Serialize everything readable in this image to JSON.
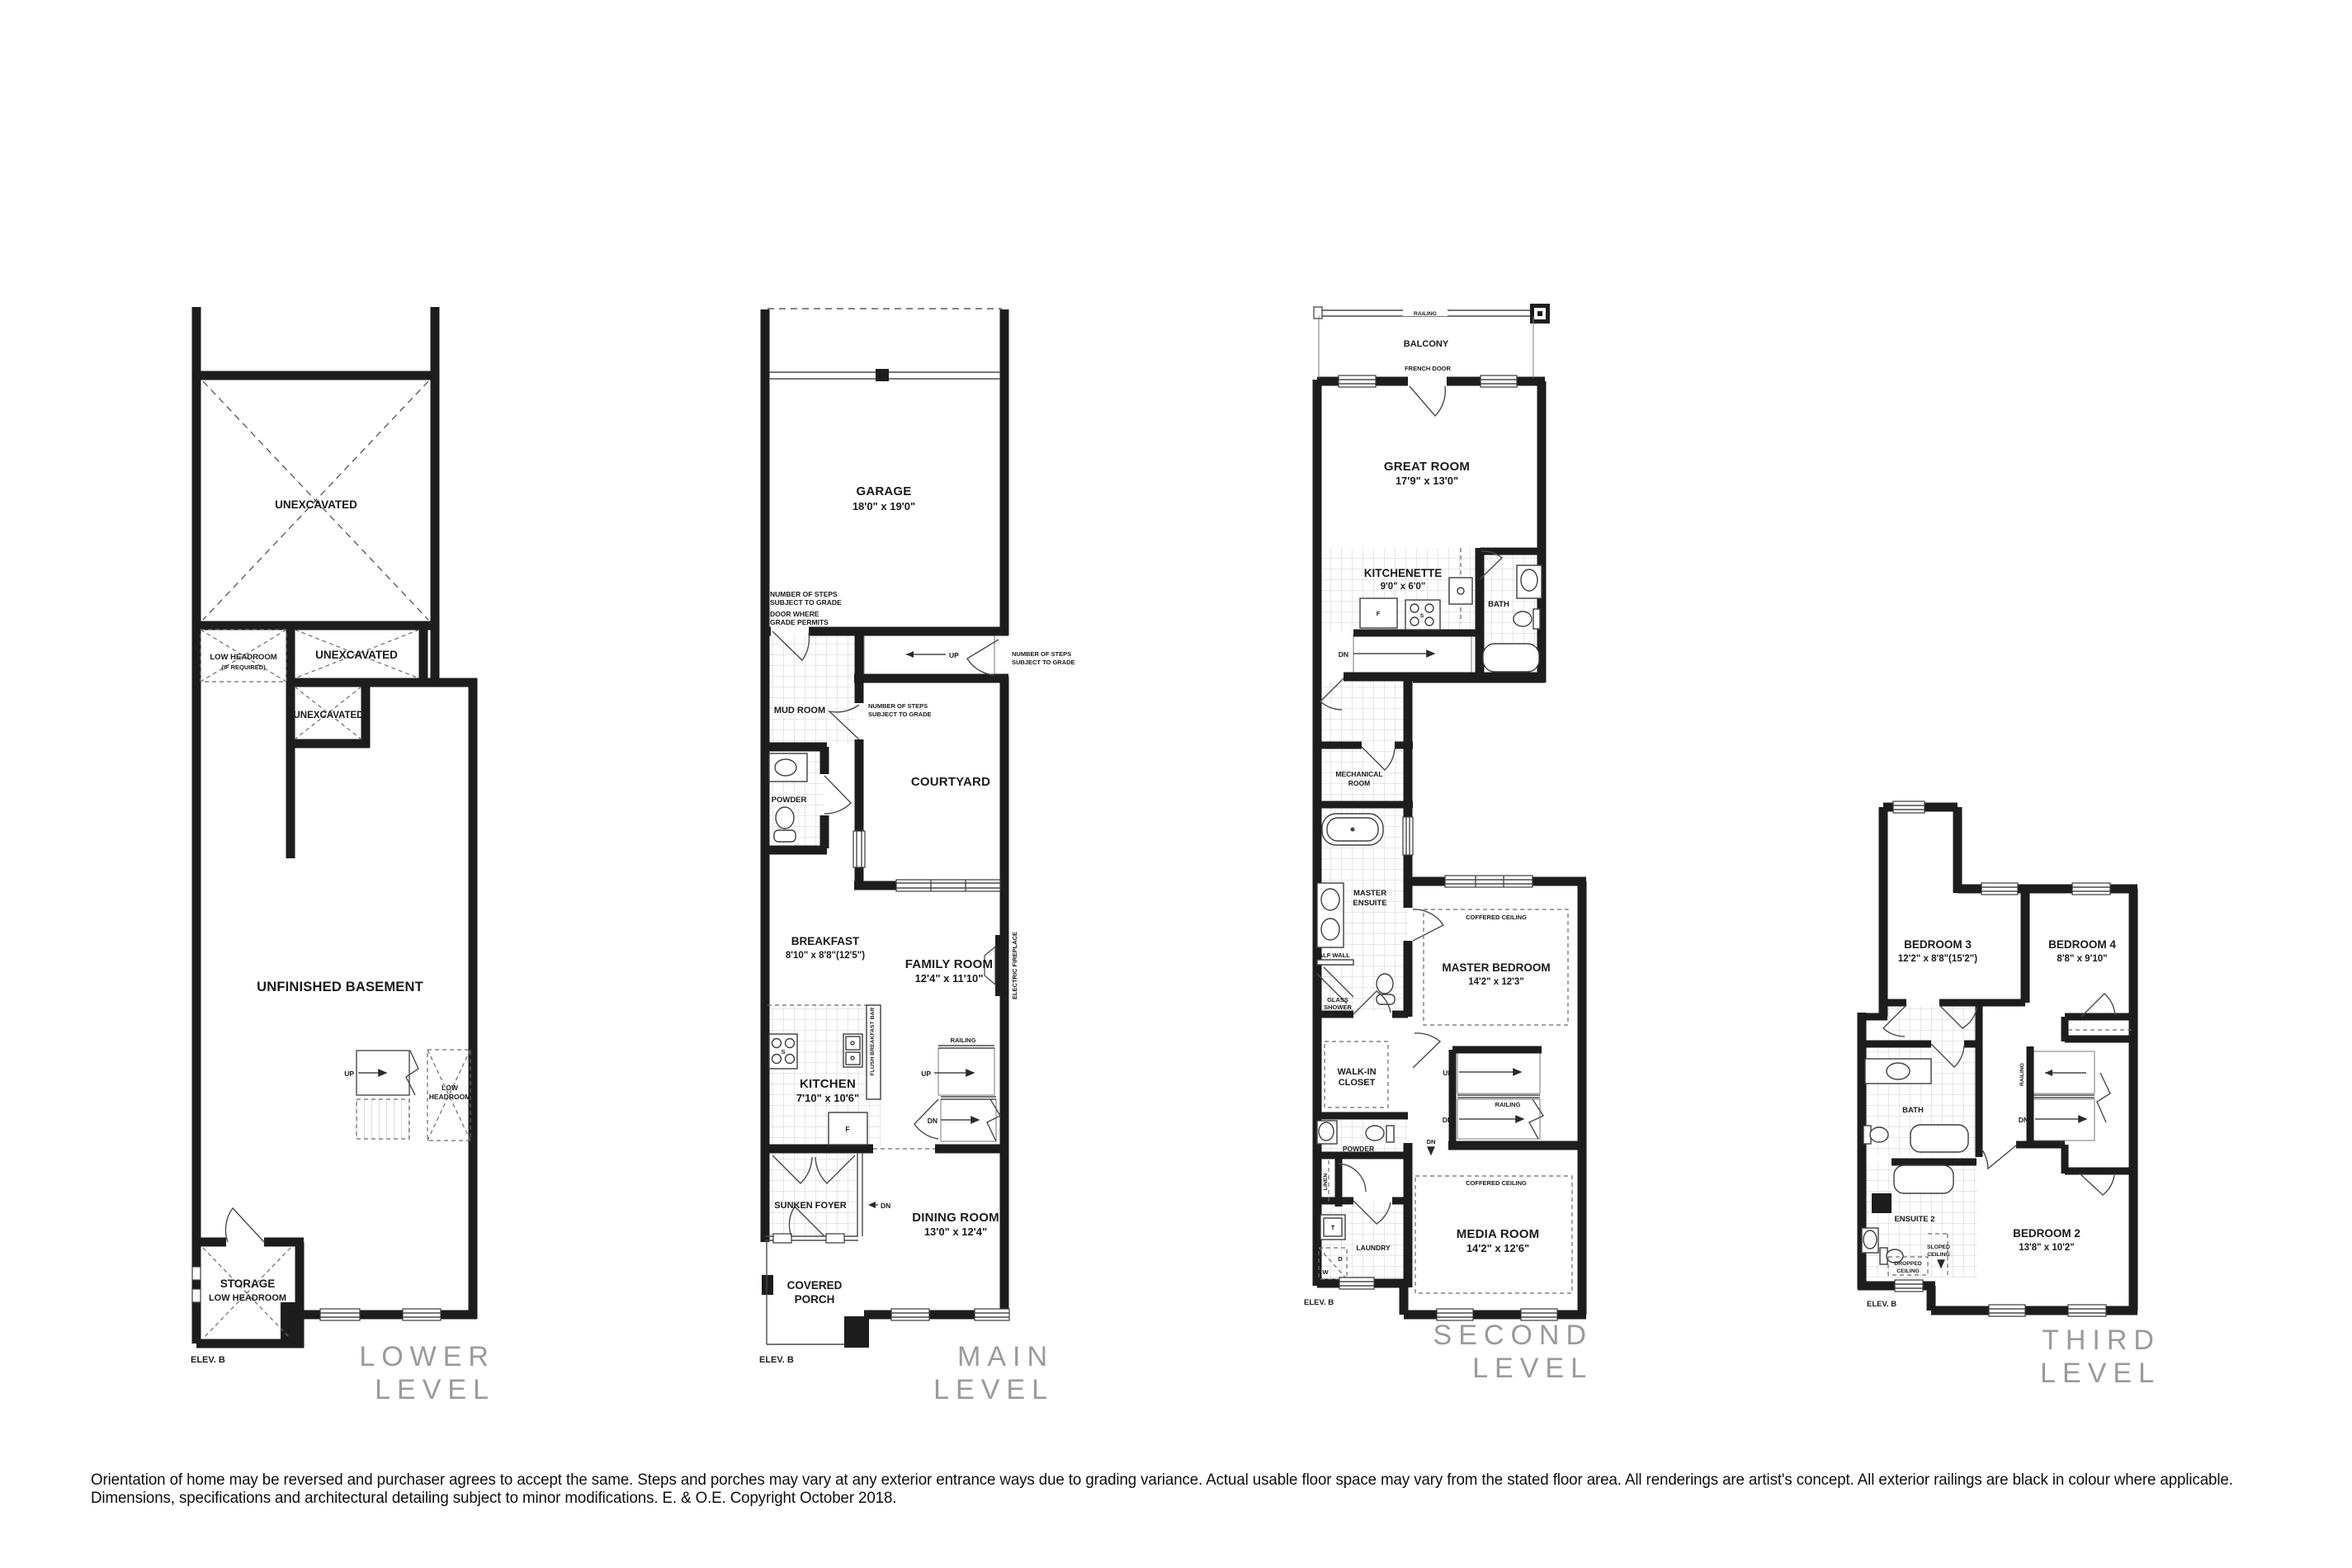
{
  "colors": {
    "wall": "#1d1d1d",
    "muted_title": "#9a9a9e",
    "tile_line": "#cfcfcf"
  },
  "disclaimer": "Orientation of home may be reversed and purchaser agrees to accept the same. Steps and porches may vary at any exterior entrance ways due to grading variance. Actual usable floor space may vary from the stated floor area. All renderings are artist's concept. All exterior railings are black in colour where applicable. Dimensions, specifications and architectural detailing subject to minor modifications. E. & O.E. Copyright October 2018.",
  "levels": {
    "lower": {
      "title": [
        "LOWER",
        "LEVEL"
      ],
      "elev": "ELEV. B",
      "labels": {
        "unex_big": "UNEXCAVATED",
        "lh1": "LOW HEADROOM",
        "lh2": "(IF REQUIRED)",
        "unex_wide": "UNEXCAVATED",
        "unex_small": "UNEXCAVATED",
        "basement": "UNFINISHED BASEMENT",
        "up": "UP",
        "low1": "LOW",
        "low2": "HEADROOM",
        "storage1": "STORAGE",
        "storage2": "LOW HEADROOM"
      }
    },
    "main": {
      "title": [
        "MAIN",
        "LEVEL"
      ],
      "elev": "ELEV. B",
      "labels": {
        "garage": "GARAGE",
        "garage_dim": "18'0\" x 19'0\"",
        "steps1a": "NUMBER OF STEPS",
        "steps1b": "SUBJECT TO GRADE",
        "door1a": "DOOR WHERE",
        "door1b": "GRADE PERMITS",
        "mud": "MUD ROOM",
        "up1": "UP",
        "steps2a": "NUMBER OF STEPS",
        "steps2b": "SUBJECT TO GRADE",
        "steps3a": "NUMBER OF STEPS",
        "steps3b": "SUBJECT TO GRADE",
        "powder": "POWDER",
        "courtyard": "COURTYARD",
        "breakfast": "BREAKFAST",
        "breakfast_dim": "8'10\" x 8'8\"(12'5\")",
        "family": "FAMILY ROOM",
        "family_dim": "12'4\" x 11'10\"",
        "fireplace": "ELECTRIC FIREPLACE",
        "kitchen": "KITCHEN",
        "kitchen_dim": "7'10\" x 10'6\"",
        "flush": "FLUSH BREAKFAST BAR",
        "railing": "RAILING",
        "up2": "UP",
        "dn1": "DN",
        "f": "F",
        "s": "S",
        "foyer": "SUNKEN FOYER",
        "dn2": "DN",
        "dining": "DINING ROOM",
        "dining_dim": "13'0\" x 12'4\"",
        "porch1": "COVERED",
        "porch2": "PORCH"
      }
    },
    "second": {
      "title": [
        "SECOND",
        "LEVEL"
      ],
      "elev": "ELEV. B",
      "labels": {
        "railing1": "RAILING",
        "balcony": "BALCONY",
        "french": "FRENCH DOOR",
        "great": "GREAT ROOM",
        "great_dim": "17'9\" x 13'0\"",
        "kitchenette": "KITCHENETTE",
        "kitchenette_dim": "9'0\" x 6'0\"",
        "f": "F",
        "s": "S",
        "bath": "BATH",
        "dn1": "DN",
        "mech1": "MECHANICAL",
        "mech2": "ROOM",
        "ens1": "MASTER",
        "ens2": "ENSUITE",
        "halfwall": "HALF WALL",
        "glass1": "GLASS",
        "glass2": "SHOWER",
        "coffered1": "COFFERED CEILING",
        "master": "MASTER BEDROOM",
        "master_dim": "14'2\" x 12'3\"",
        "walkin1": "WALK-IN",
        "walkin2": "CLOSET",
        "up": "UP",
        "railing2": "RAILING",
        "dn2": "DN",
        "powder": "POWDER",
        "dn3": "DN",
        "linen": "LINEN",
        "coffered2": "COFFERED CEILING",
        "t": "T",
        "d": "D",
        "w": "W",
        "laundry": "LAUNDRY",
        "media": "MEDIA ROOM",
        "media_dim": "14'2\" x 12'6\""
      }
    },
    "third": {
      "title": [
        "THIRD",
        "LEVEL"
      ],
      "elev": "ELEV. B",
      "labels": {
        "bed3": "BEDROOM 3",
        "bed3_dim": "12'2\" x 8'8\"(15'2\")",
        "bed4": "BEDROOM 4",
        "bed4_dim": "8'8\" x 9'10\"",
        "railing": "RAILING",
        "dn": "DN",
        "bath": "BATH",
        "ensuite": "ENSUITE 2",
        "sloped1": "SLOPED",
        "sloped2": "CEILING",
        "dropped1": "DROPPED",
        "dropped2": "CEILING",
        "bed2": "BEDROOM 2",
        "bed2_dim": "13'8\" x 10'2\"",
        "elev": "ELEV. B"
      }
    }
  }
}
